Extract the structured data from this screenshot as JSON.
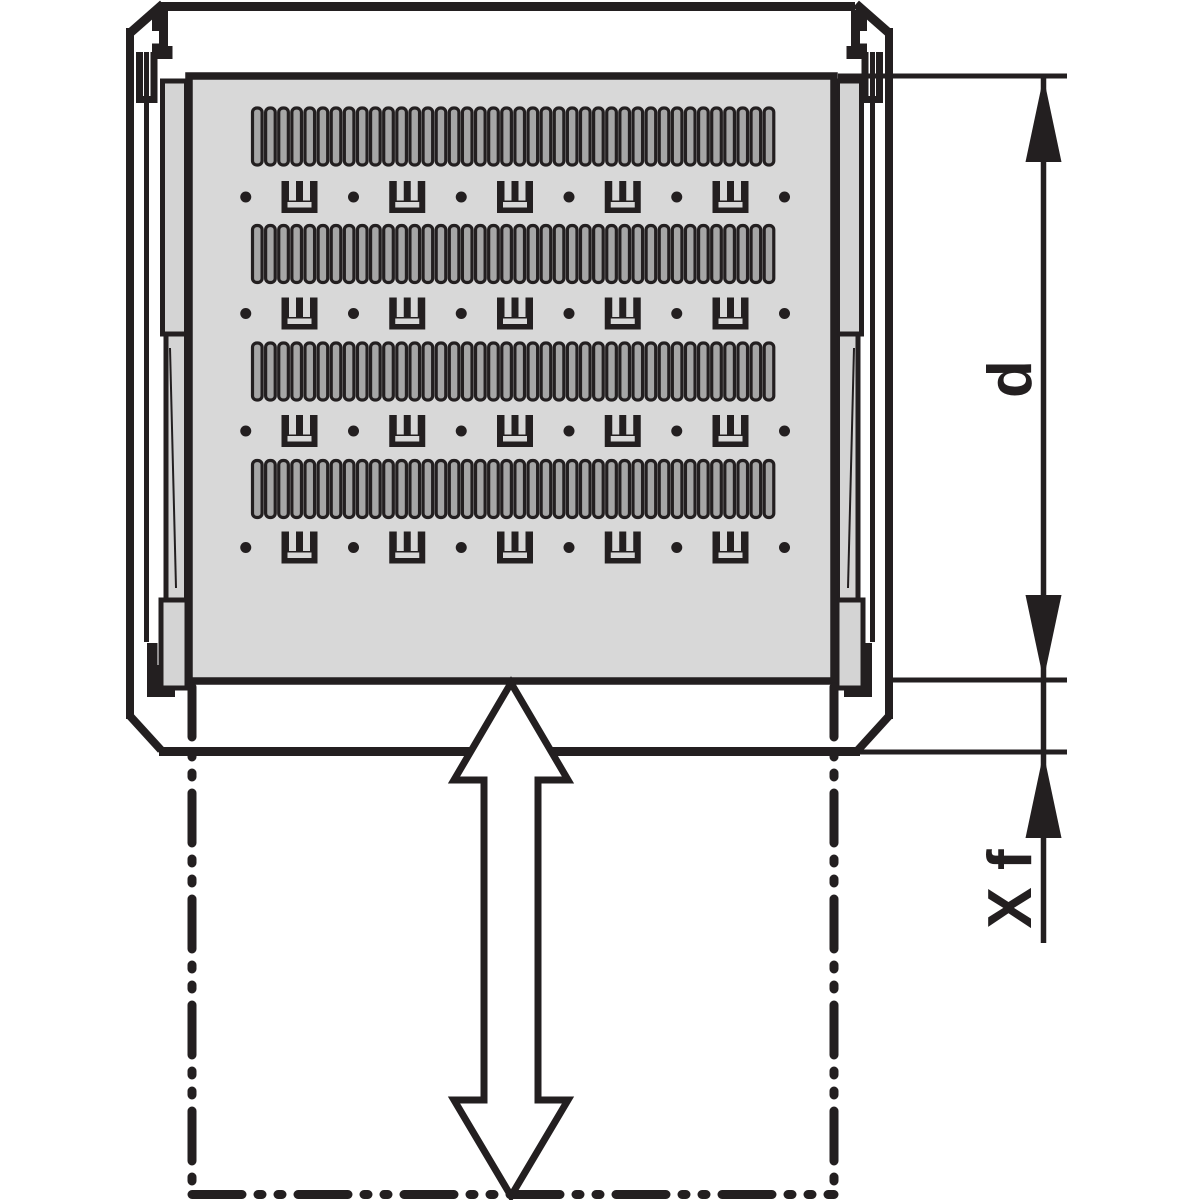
{
  "diagram": {
    "type": "technical_line_drawing",
    "subject": "Rack cabinet top view with telescopic sliding shelf; extension travel shown as phantom outline",
    "labels": {
      "depth_dimension": "d",
      "extension_dimension": "X f"
    },
    "colors": {
      "line": "#231f20",
      "shelf_fill": "#d8d8d8",
      "rail_fill": "#d4d4d4",
      "slot_fill": "#a6a6a6",
      "background": "#ffffff"
    },
    "shelf": {
      "vent_rows": 4,
      "slots_per_row": 40,
      "bracket_rows": 4,
      "brackets_per_row": 5,
      "holes_per_row": 6
    }
  }
}
